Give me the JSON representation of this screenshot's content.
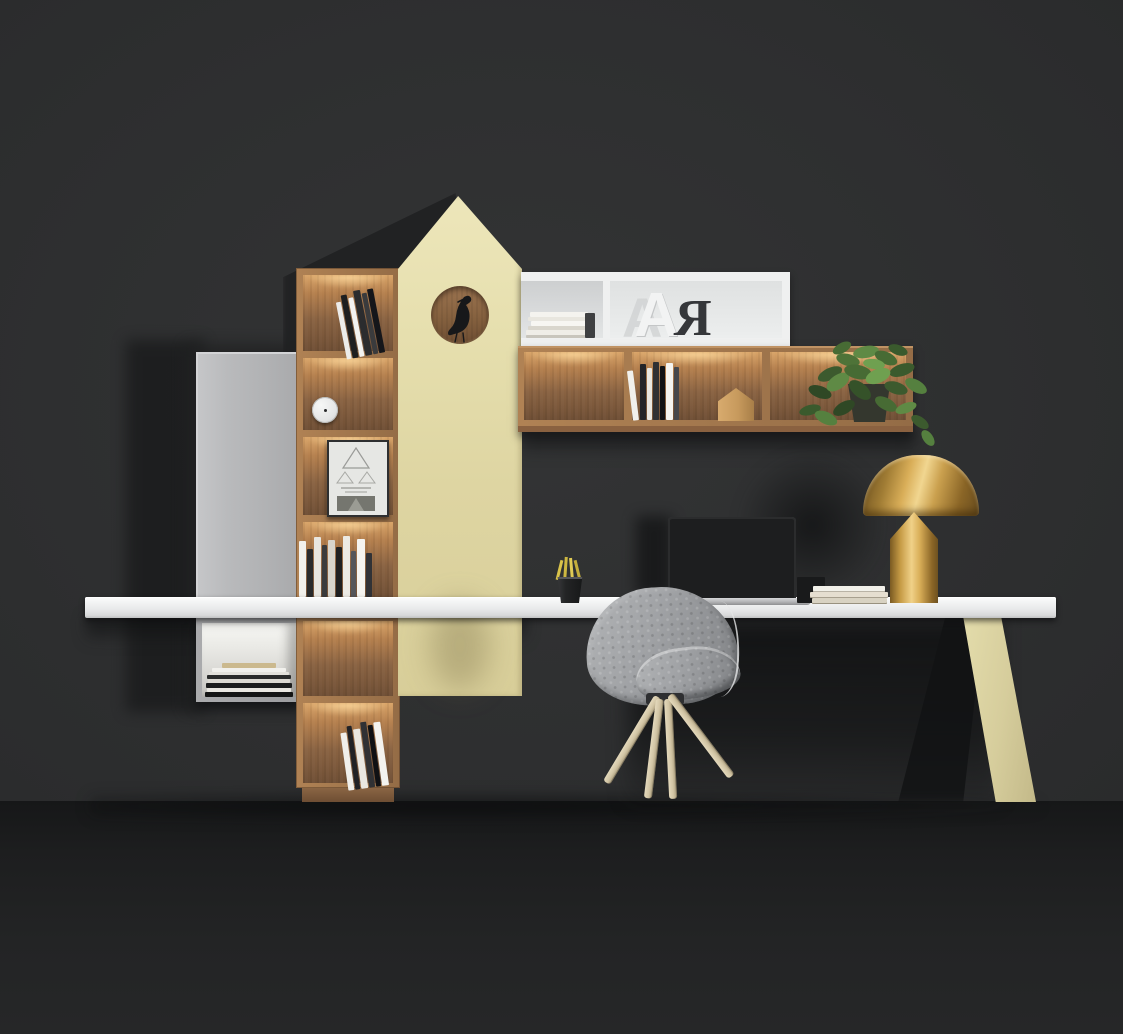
{
  "scene": {
    "kind": "furniture-render",
    "objects": [
      "grey cabinet door",
      "backlit wooden shelf tower with books, clock and framed art",
      "cream house-shaped panel with circular cutout and black bird figurine",
      "white floating shelf with stacked books and decorative letters",
      "backlit wooden wall shelf with books, wooden house figurine and trailing plant",
      "white floating desk",
      "laptop with dark screen",
      "stack of books",
      "gold mushroom table lamp",
      "black pencil cup with pencils",
      "grey quilted shell chair on splayed wooden legs",
      "cream angled desk leg"
    ]
  },
  "decor": {
    "letter_a": "A",
    "letter_r": "R"
  },
  "palette": {
    "wall": "#2e2f30",
    "wallShadow": "#1e1f20",
    "floor": "#1f2021",
    "cream": "#e6dfad",
    "creamDark": "#cfc694",
    "wood": "#a87c52",
    "woodLit": "#d9a468",
    "woodDeep": "#6f4f35",
    "white": "#f2f3f4",
    "grayDoor": "#b7b8ba",
    "gold": "#c9a04e",
    "goldDeep": "#7a5a22",
    "goldHi": "#f1d690",
    "chairGray": "#9da0a2",
    "chairHi": "#e8e9ea",
    "legWood": "#d6c9ab",
    "leaf": "#4e7338",
    "leafDark": "#31502a",
    "leafLight": "#6fa050",
    "screen": "#1d1e1f",
    "silver": "#b9babc",
    "black": "#1a1b1c",
    "bookWhite": "#f2f1ec",
    "bookDark": "#26272a",
    "bookTan": "#e0d9c8",
    "clockFace": "#eceded",
    "letterLight": "#f0f1f2",
    "letterDark": "#35373a"
  }
}
